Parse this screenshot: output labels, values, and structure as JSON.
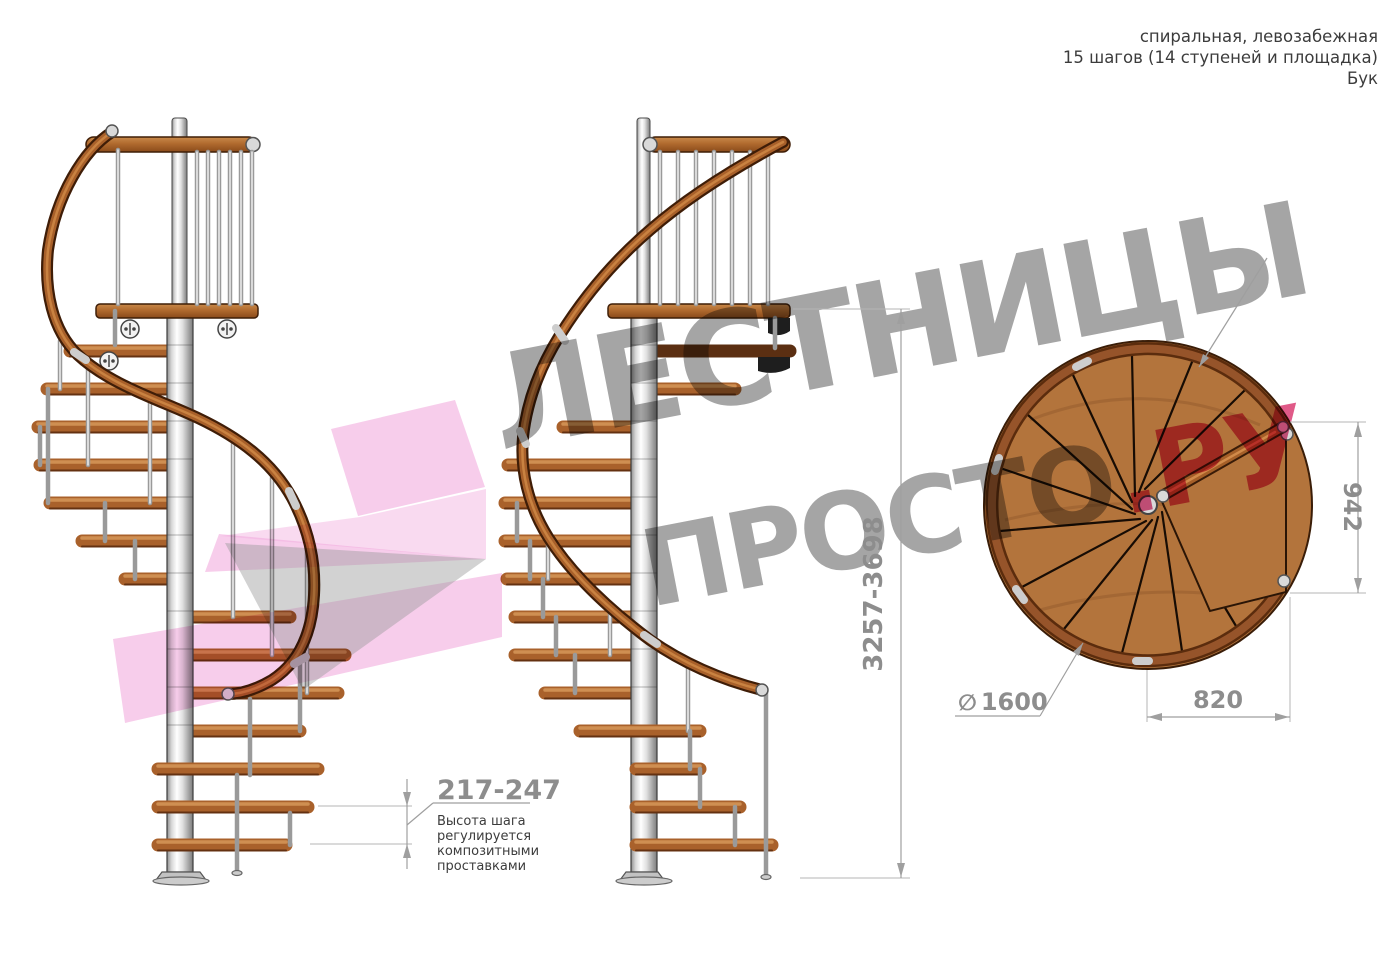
{
  "title_block": {
    "lines": [
      "спиральная, левозабежная",
      "15 шагов (14 ступеней и площадка)",
      "Бук"
    ]
  },
  "watermark": {
    "line1": "ЛЕСТНИЦЫ",
    "line2_gray": "ПРОСТО",
    "line2_pink": ".РУ"
  },
  "dimensions": {
    "step_height": {
      "value": "217-247",
      "note": [
        "Высота шага",
        "регулируется",
        "композитными",
        "проставками"
      ]
    },
    "total_height": {
      "value": "3257-3698"
    },
    "landing_depth": {
      "value": "942"
    },
    "diameter": {
      "symbol": "∅",
      "value": "1600"
    },
    "landing_width": {
      "value": "820"
    }
  },
  "colors": {
    "wood": "#b06a2e",
    "wood_dark": "#5b2f12",
    "handrail": "#a8602a",
    "pole": "#d8d8d8",
    "dimension_gray": "#8d8d8d",
    "note_text": "#3c3c3c",
    "watermark_gray": "#a5a5a5",
    "watermark_pink": "#e05a88",
    "logo_pink": "#f2aede"
  }
}
